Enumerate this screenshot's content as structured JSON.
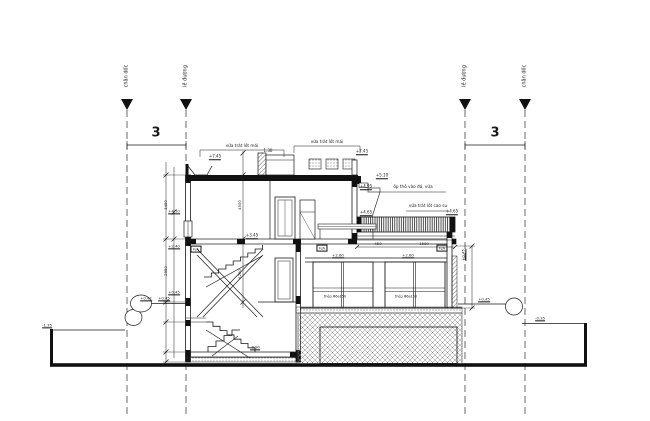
{
  "drawing": {
    "type": "architectural-section-elevation",
    "background": "#ffffff",
    "line_color": "#1a1a1a",
    "grid_bubble_label": "3",
    "axes": {
      "left_outer_label": "chân dốc",
      "left_inner_label": "lề đường",
      "right_inner_label": "lề đường",
      "right_outer_label": "chân dốc"
    },
    "annotations": [
      {
        "name": "axis-label-left-outer",
        "text": "chân dốc",
        "x": 127,
        "y": 76,
        "rot": true,
        "size": 5
      },
      {
        "name": "axis-label-left-inner",
        "text": "lề đường",
        "x": 186,
        "y": 76,
        "rot": true,
        "size": 5
      },
      {
        "name": "axis-label-right-inner",
        "text": "lề đường",
        "x": 465,
        "y": 76,
        "rot": true,
        "size": 5
      },
      {
        "name": "axis-label-right-outer",
        "text": "chân dốc",
        "x": 525,
        "y": 76,
        "rot": true,
        "size": 5
      },
      {
        "name": "axis-dim-left",
        "text": "3",
        "x": 156,
        "y": 133,
        "size": 13,
        "weight": 700
      },
      {
        "name": "axis-dim-right",
        "text": "3",
        "x": 495,
        "y": 133,
        "size": 13,
        "weight": 700
      },
      {
        "name": "roof-note-1",
        "text": "vữa trát lót mái",
        "x": 242,
        "y": 146,
        "size": 4.2
      },
      {
        "name": "roof-note-2",
        "text": "vữa trát lót mái",
        "x": 327,
        "y": 142,
        "size": 4.2
      },
      {
        "name": "level-roof-1",
        "text": "+7.45",
        "x": 215,
        "y": 157,
        "size": 4,
        "flag": true
      },
      {
        "name": "dim-roof",
        "text": "1.30",
        "x": 268,
        "y": 151,
        "size": 4
      },
      {
        "name": "level-roof-2",
        "text": "+7.45",
        "x": 362,
        "y": 152,
        "size": 4,
        "flag": true
      },
      {
        "name": "level-scupper",
        "text": "+5.10",
        "x": 382,
        "y": 176,
        "size": 4,
        "flag": true
      },
      {
        "name": "level-downspout",
        "text": "+4.95",
        "x": 366,
        "y": 187,
        "size": 4,
        "flag": true
      },
      {
        "name": "terrace-note-1",
        "text": "ốp thô vào đá, vữa",
        "x": 413,
        "y": 187,
        "size": 4.2
      },
      {
        "name": "terrace-note-2",
        "text": "vữa trát lót cao su",
        "x": 428,
        "y": 206,
        "size": 4.2
      },
      {
        "name": "level-terrace-left",
        "text": "+4.65",
        "x": 366,
        "y": 213,
        "size": 4,
        "flag": true
      },
      {
        "name": "level-terrace-right",
        "text": "+4.65",
        "x": 452,
        "y": 212,
        "size": 4,
        "flag": true
      },
      {
        "name": "dim-terrace-1",
        "text": "450",
        "x": 378,
        "y": 244,
        "size": 3.8
      },
      {
        "name": "dim-terrace-2",
        "text": "1500",
        "x": 424,
        "y": 244,
        "size": 3.8
      },
      {
        "name": "level-veranda",
        "text": "+0.45",
        "x": 464,
        "y": 255,
        "rot": true,
        "size": 3.8,
        "flag": true
      },
      {
        "name": "floor-tag-left",
        "text": "F/A",
        "x": 196,
        "y": 249,
        "size": 3.8,
        "box": true
      },
      {
        "name": "floor-tag-mid",
        "text": "F/A",
        "x": 322,
        "y": 248,
        "size": 3.8,
        "box": true
      },
      {
        "name": "floor-tag-right",
        "text": "F/A",
        "x": 442,
        "y": 248,
        "size": 3.8,
        "box": true
      },
      {
        "name": "level-floor2",
        "text": "+3.45",
        "x": 252,
        "y": 236,
        "size": 4,
        "flag": true
      },
      {
        "name": "level-window-1",
        "text": "+2.60",
        "x": 338,
        "y": 256,
        "size": 3.8,
        "flag": true
      },
      {
        "name": "level-window-2",
        "text": "+2.60",
        "x": 408,
        "y": 256,
        "size": 3.8,
        "flag": true
      },
      {
        "name": "rebar-note-1",
        "text": "thép Φ6a150",
        "x": 335,
        "y": 297,
        "size": 3.4
      },
      {
        "name": "rebar-note-2",
        "text": "thép Φ6a150",
        "x": 406,
        "y": 297,
        "size": 3.4
      },
      {
        "name": "level-wall-1",
        "text": "+4.50",
        "x": 174,
        "y": 212,
        "size": 3.8,
        "flag": true
      },
      {
        "name": "level-wall-2",
        "text": "+2.40",
        "x": 174,
        "y": 247,
        "size": 3.8,
        "flag": true
      },
      {
        "name": "level-wall-3",
        "text": "+0.45",
        "x": 174,
        "y": 293,
        "size": 3.8,
        "flag": true
      },
      {
        "name": "chain-dim-1",
        "text": "3450",
        "x": 166,
        "y": 205,
        "rot": true,
        "size": 3.8
      },
      {
        "name": "chain-dim-2",
        "text": "2950",
        "x": 166,
        "y": 271,
        "rot": true,
        "size": 3.8
      },
      {
        "name": "chain-dim-3",
        "text": "4500",
        "x": 240,
        "y": 205,
        "rot": true,
        "size": 3.8
      },
      {
        "name": "chain-dim-4",
        "text": "6200",
        "x": 240,
        "y": 274,
        "rot": true,
        "size": 3.8
      },
      {
        "name": "level-ground-left-a",
        "text": "+0.42",
        "x": 146,
        "y": 299,
        "size": 3.8,
        "flag": true
      },
      {
        "name": "level-ground-left-b",
        "text": "+0.45",
        "x": 164,
        "y": 299,
        "size": 3.8,
        "flag": true
      },
      {
        "name": "level-ground-far-left",
        "text": "-1.35",
        "x": 47,
        "y": 326,
        "size": 3.8,
        "flag": true
      },
      {
        "name": "level-ground-right-a",
        "text": "+0.45",
        "x": 484,
        "y": 300,
        "size": 3.8,
        "flag": true
      },
      {
        "name": "level-ground-right-b",
        "text": "-0.35",
        "x": 540,
        "y": 319,
        "size": 3.8,
        "flag": true
      },
      {
        "name": "level-basement",
        "text": "-0.90",
        "x": 255,
        "y": 348,
        "size": 3.8,
        "flag": true
      }
    ]
  }
}
